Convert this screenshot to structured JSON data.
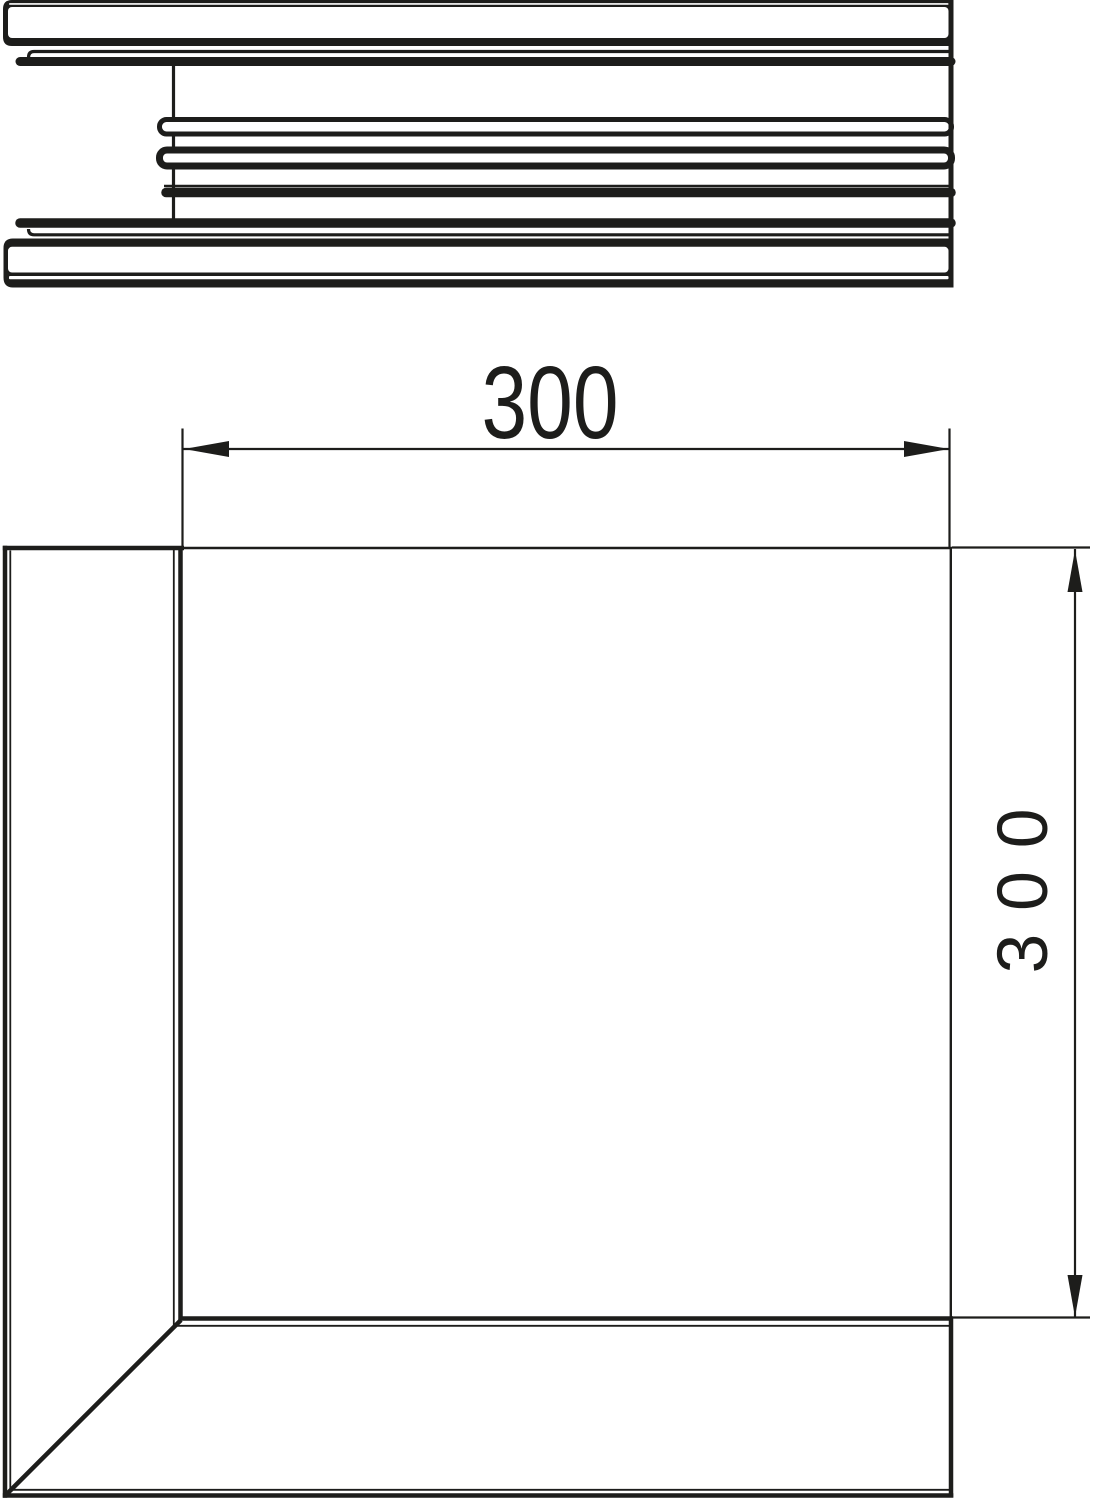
{
  "drawing": {
    "dimensions": {
      "width_label": "300",
      "height_label": "300"
    },
    "colors": {
      "line": "#1d1d1b",
      "background": "#ffffff"
    }
  }
}
